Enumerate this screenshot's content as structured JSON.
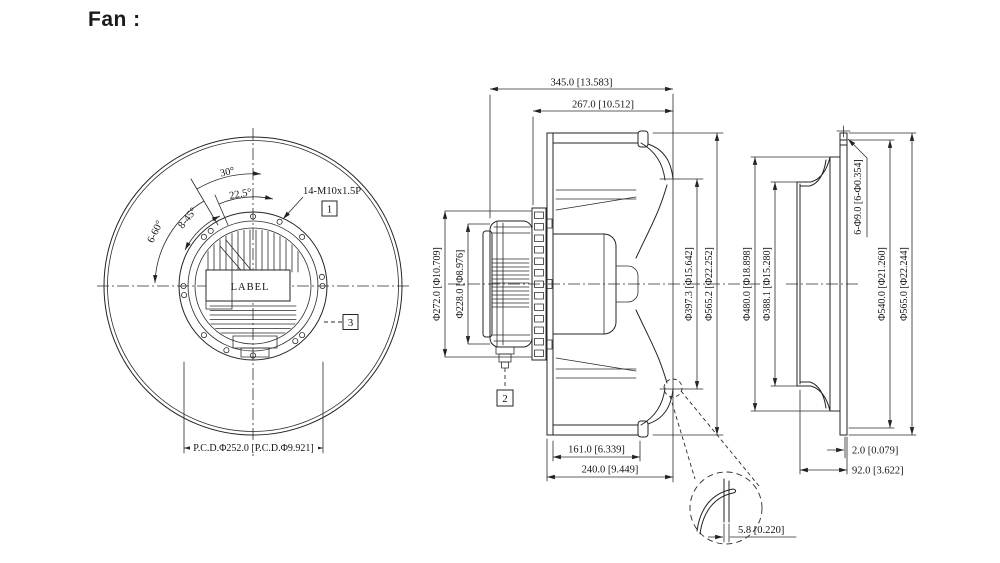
{
  "title": "Fan :",
  "front_view": {
    "angle_30": "30°",
    "angle_22_5": "22.5°",
    "angle_8_45": "8-45°",
    "angle_6_60": "6-60°",
    "thread_callout": "14-M10x1.5P",
    "balloon_1": "1",
    "balloon_3": "3",
    "motor_label": "LABEL",
    "pcd_dim": "P.C.D.Φ252.0 [P.C.D.Φ9.921]"
  },
  "side_view": {
    "overall_depth": "345.0 [13.583]",
    "housing_depth": "267.0 [10.512]",
    "motor_flange_dia": "Φ272.0 [Φ10.709]",
    "motor_body_dia": "Φ228.0 [Φ8.976]",
    "inlet_dia": "Φ397.3 [Φ15.642]",
    "impeller_dia": "Φ565.2 [Φ22.252]",
    "plate_to_inlet": "161.0 [6.339]",
    "plate_to_front": "240.0 [9.449]",
    "balloon_2": "2"
  },
  "inlet_ring_view": {
    "step_dia": "Φ480.0 [Φ18.898]",
    "throat_dia": "Φ388.1 [Φ15.280]",
    "mount_holes": "6-Φ9.0 [6-Φ0.354]",
    "bolt_circle_dia": "Φ540.0 [Φ21.260]",
    "flange_dia": "Φ565.0 [Φ22.244]",
    "sheet_thickness": "2.0 [0.079]",
    "ring_depth": "92.0 [3.622]"
  },
  "detail_view": {
    "lip_dim": "5.8 [0.220]"
  }
}
